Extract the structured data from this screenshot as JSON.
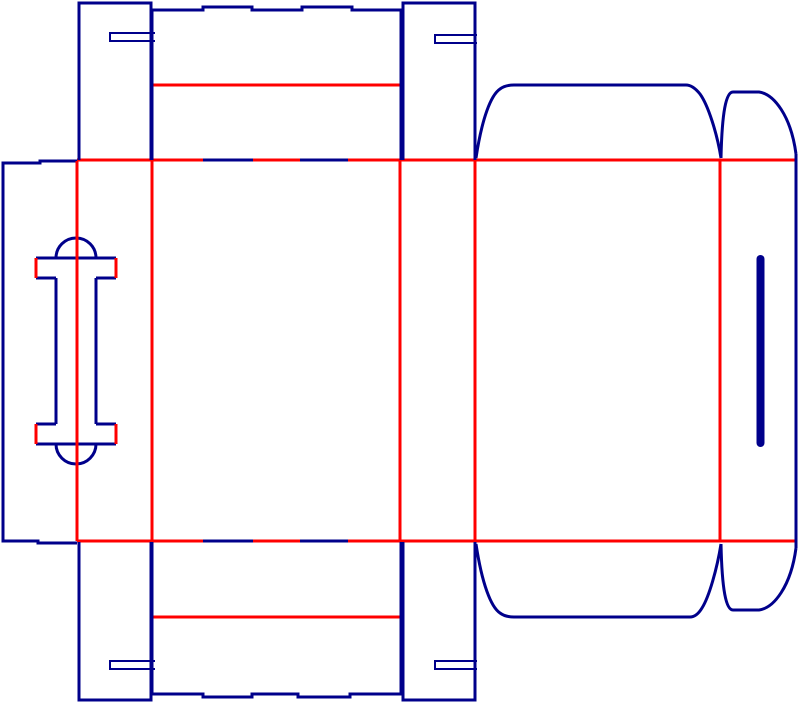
{
  "canvas": {
    "width": 800,
    "height": 704,
    "background": "#ffffff"
  },
  "colors": {
    "cut": "#00008B",
    "crease": "#FF0000"
  },
  "dieline": {
    "creases": [
      {
        "name": "fold-glue-panel",
        "d": "M77,160 V541",
        "w": 3
      },
      {
        "name": "fold-panel2-left",
        "d": "M152,160 V541",
        "w": 3
      },
      {
        "name": "fold-panel2-right",
        "d": "M400,160 V541",
        "w": 3
      },
      {
        "name": "fold-panel4-left",
        "d": "M475,160 V541",
        "w": 3
      },
      {
        "name": "fold-panel4-right",
        "d": "M720,160 V541",
        "w": 3
      },
      {
        "name": "fold-top-flaps",
        "d": "M77,160 H796",
        "w": 3
      },
      {
        "name": "fold-bottom-flaps",
        "d": "M77,541 H796",
        "w": 3
      },
      {
        "name": "fold-top-wide-flap",
        "d": "M152,85 H400",
        "w": 3
      },
      {
        "name": "fold-bottom-wide-flap",
        "d": "M152,617 H400",
        "w": 3
      }
    ],
    "cuts": [
      {
        "name": "glue-panel-outline",
        "d": "M77,161 H40 V163 H3 V541 H38 V543 H77",
        "w": 3
      },
      {
        "name": "top-left-dust-flap",
        "d": "M79,160 V3 H151 V160",
        "w": 3
      },
      {
        "name": "top-left-lock-slit",
        "d": "M155,33 H110 V41 H155",
        "w": 2
      },
      {
        "name": "top-wide-flap",
        "d": "M152,160 V10 H203 V7 H252 V10 H302 V7 H352 V10 H401 V160",
        "w": 3
      },
      {
        "name": "top-right-dust-flap",
        "d": "M403,160 V3 H475 V160",
        "w": 3
      },
      {
        "name": "top-right-lock-slit",
        "d": "M477,35 H435 V43 H477",
        "w": 2
      },
      {
        "name": "top-main-flap",
        "d": "M476,158 C482,118 491,95 500,89 C504,86 509,85 514,85 L686,85 C691,85 696,89 700,94 C708,105 717,133 721,158",
        "w": 3
      },
      {
        "name": "top-dome-flap",
        "d": "M721,158 C722,112 726,92 733,92 L759,92 C774,94 791,116 796,154",
        "w": 3
      },
      {
        "name": "right-end-edge",
        "d": "M796,154 V548",
        "w": 3
      },
      {
        "name": "bottom-dome-flap",
        "d": "M721,544 C722,590 726,610 733,610 L759,610 C774,608 791,586 796,548",
        "w": 3
      },
      {
        "name": "bottom-main-flap",
        "d": "M476,544 C482,584 491,607 500,613 C504,616 509,617 514,617 L690,617 C695,617 699,613 702,608 C709,597 717,569 721,544",
        "w": 3
      },
      {
        "name": "bottom-left-dust-flap",
        "d": "M79,542 V700 H151 V542",
        "w": 3
      },
      {
        "name": "bottom-left-lock-slit",
        "d": "M155,661 H110 V669 H155",
        "w": 2
      },
      {
        "name": "bottom-wide-flap",
        "d": "M152,542 V694 H203 V697 H252 V694 H298 V697 H350 V694 H401 V542",
        "w": 3
      },
      {
        "name": "bottom-right-dust-flap",
        "d": "M403,542 V700 H475 V542",
        "w": 3
      },
      {
        "name": "bottom-right-lock-slit",
        "d": "M477,661 H435 V669 H477",
        "w": 2
      },
      {
        "name": "crease-cut-segments-top",
        "d": "M203,160 H253 M300,160 H348",
        "w": 3
      },
      {
        "name": "crease-cut-segments-bottom",
        "d": "M203,541 H253 M300,541 H348",
        "w": 3
      },
      {
        "name": "handle-top-arc",
        "d": "M56,258 A20,20 0 0 1 96,258",
        "w": 3
      },
      {
        "name": "handle-top-bar",
        "d": "M36,258 H116",
        "w": 3
      },
      {
        "name": "handle-top-shoulders",
        "d": "M36,278 H56 M96,278 H116",
        "w": 3
      },
      {
        "name": "handle-stems",
        "d": "M56,278 V424 M96,278 V424",
        "w": 3
      },
      {
        "name": "handle-bottom-shoulders",
        "d": "M36,424 H56 M96,424 H116",
        "w": 3
      },
      {
        "name": "handle-bottom-bar",
        "d": "M36,444 H116",
        "w": 3
      },
      {
        "name": "handle-bottom-arc",
        "d": "M56,444 A20,20 0 0 0 96,444",
        "w": 3
      }
    ],
    "creases_top": [
      {
        "name": "handle-center-crease",
        "d": "M77,161 V541",
        "w": 3
      },
      {
        "name": "handle-cap-creases",
        "d": "M36,258 V278 M116,258 V278 M36,424 V444 M116,424 V444",
        "w": 3
      }
    ],
    "slot": {
      "name": "right-panel-finger-slot",
      "x": 756.5,
      "y": 255,
      "width": 8,
      "height": 192,
      "rx": 4
    }
  }
}
